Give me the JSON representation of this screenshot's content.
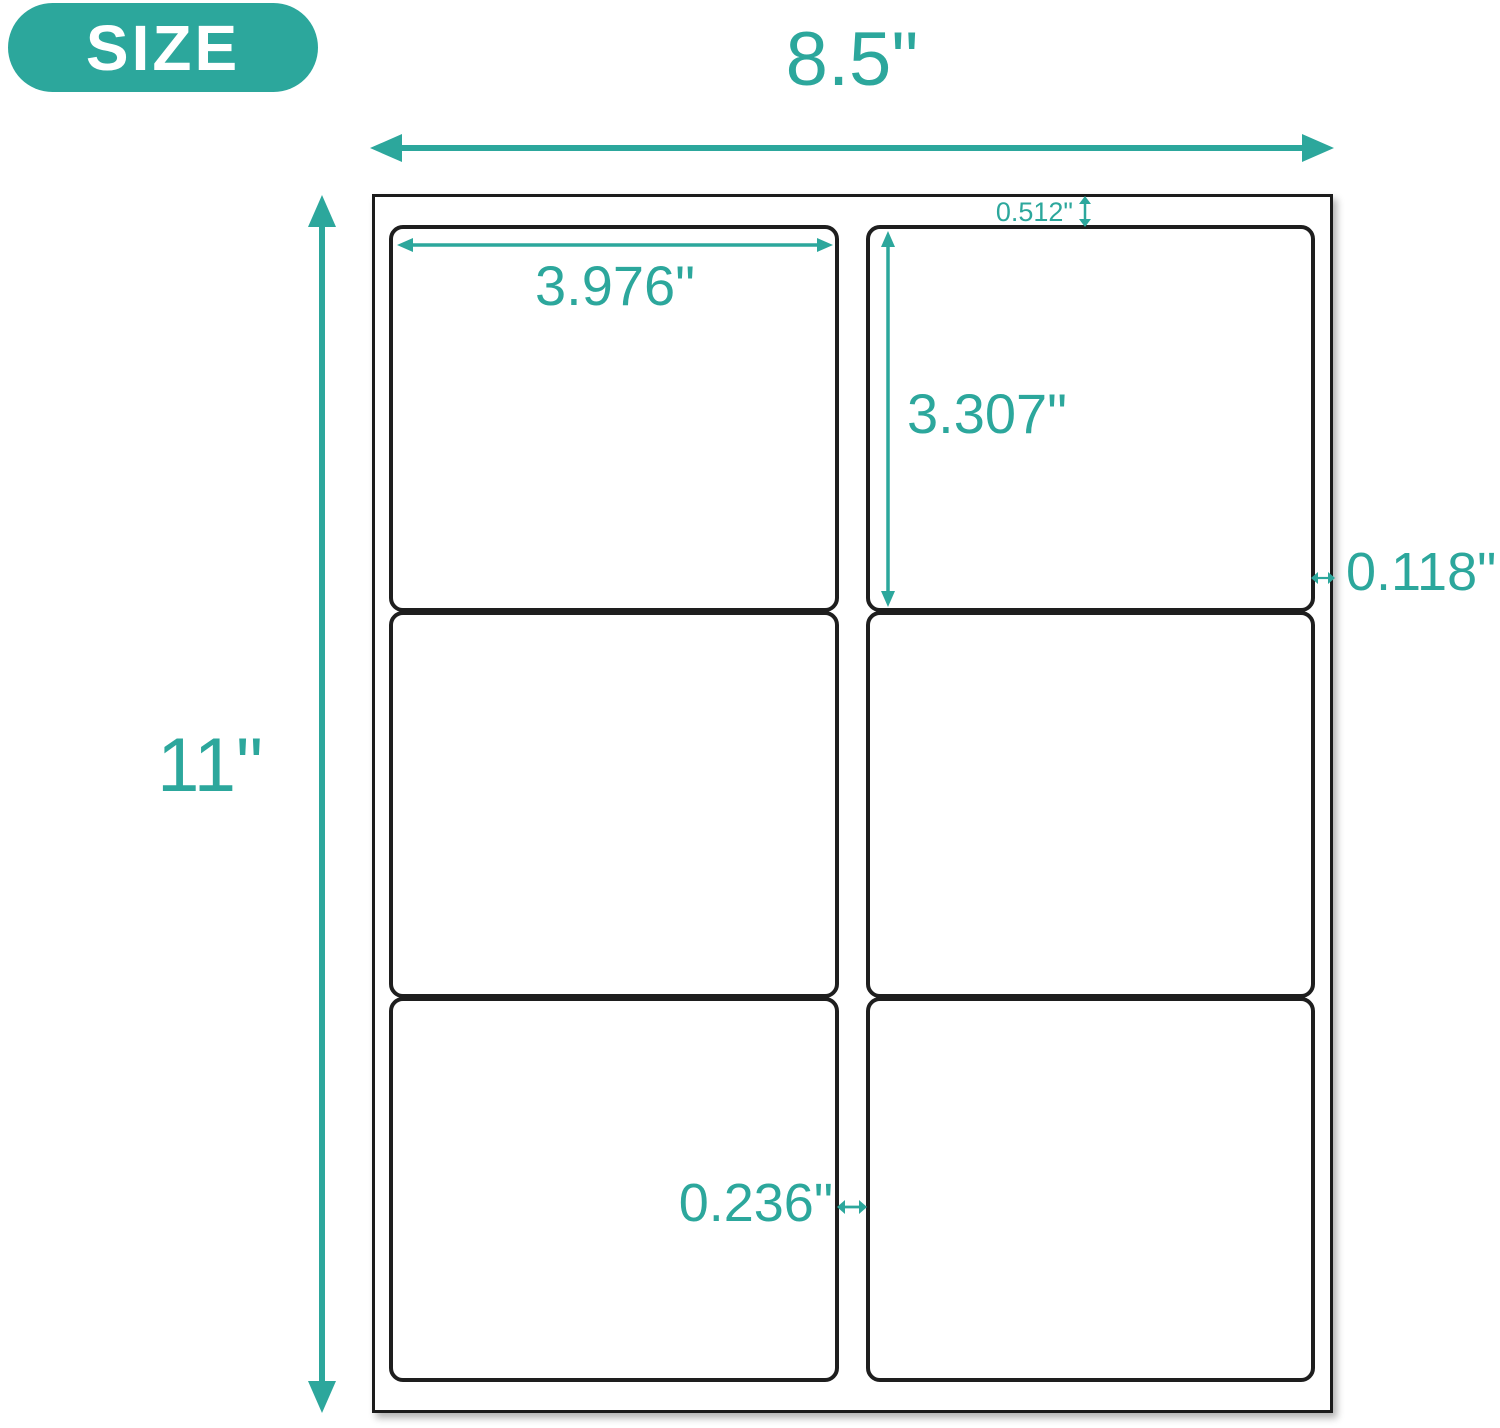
{
  "colors": {
    "accent": "#2CA79C",
    "badge_text": "#FFFFFF",
    "sheet_border": "#1B1B1B",
    "cell_border": "#1E1E1E",
    "background": "#FFFFFF"
  },
  "badge": {
    "label": "SIZE"
  },
  "sheet": {
    "width": "8.5\"",
    "height": "11\""
  },
  "cell": {
    "width": "3.976\"",
    "height": "3.307\""
  },
  "spacing": {
    "top_margin": "0.512\"",
    "side_margin": "0.118\"",
    "column_gap": "0.236\""
  }
}
